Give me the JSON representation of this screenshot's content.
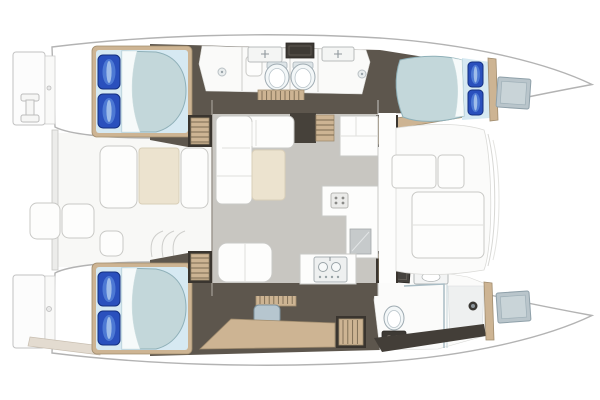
{
  "scene": {
    "type": "floorplan",
    "subject": "Sailing catamaran accommodation deck plan, top-down view, bow pointing right",
    "orientation": "bow-right",
    "hulls": {
      "port": {
        "label": "port hull (top)",
        "areas": [
          "swim-platform with boarding ladder",
          "aft double cabin with island bed and two blue pillows",
          "aft ensuite bathroom with sink, shower seat and toilet",
          "forward ensuite bathroom with sink, shower and toilet",
          "teak grating corridor",
          "forward double cabin with island bed and two blue pillows",
          "bow locker with deck hatch"
        ]
      },
      "starboard": {
        "label": "starboard hull (bottom)",
        "areas": [
          "swim-platform with boarding step",
          "aft double cabin with island bed and two blue pillows",
          "vanity desk with stool",
          "companionway steps",
          "forward bathroom with basin, shower stall and toilet",
          "bow locker with deck hatch"
        ]
      }
    },
    "bridgedeck": {
      "aft_cockpit": [
        "aft crossbeam",
        "stern platform seats",
        "cockpit table",
        "port bench",
        "starboard bench",
        "corner seat",
        "step lines"
      ],
      "salon": [
        "L-shaped sofa",
        "cream ottoman coffee table",
        "aft bench seat",
        "galley L-counter with cooktop",
        "refrigerator",
        "sink counter with twin basins",
        "forward cabinet",
        "four companionway step flights"
      ],
      "forward_cockpit": [
        "side walkway",
        "two forward seats",
        "sun pad",
        "curved deck edge"
      ]
    }
  },
  "colors": {
    "page_bg": "#ffffff",
    "hull_fill": "#ffffff",
    "hull_stroke": "#b3b3b3",
    "deck_white": "#f8f8f6",
    "furniture_white": "#fdfdfc",
    "furniture_stroke": "#c9c9c6",
    "dark_floor": "#5d564d",
    "step_dark": "#3a352f",
    "wood": "#cdb493",
    "wood_stroke": "#a08c6e",
    "salon_floor": "#c8c6c1",
    "cream": "#ece3cf",
    "duvet": "#c3d7da",
    "duvet_stroke": "#8fb0b8",
    "sheet_fold": "#f6fafa",
    "headboard": "#d6e9f2",
    "pillow": "#2a50bd",
    "pillow_dark": "#142f80",
    "pillow_mid": "#4d79d4",
    "pillow_light": "#a9c4ec",
    "stool": "#b6c6cf",
    "hatch": "#b9c5cb",
    "hatch_stroke": "#8fa0a9",
    "porcelain": "#f3f7f8",
    "porcelain_stroke": "#9fabb2",
    "appliance": "#c6cacb",
    "dark_panel": "#3e3a35"
  }
}
